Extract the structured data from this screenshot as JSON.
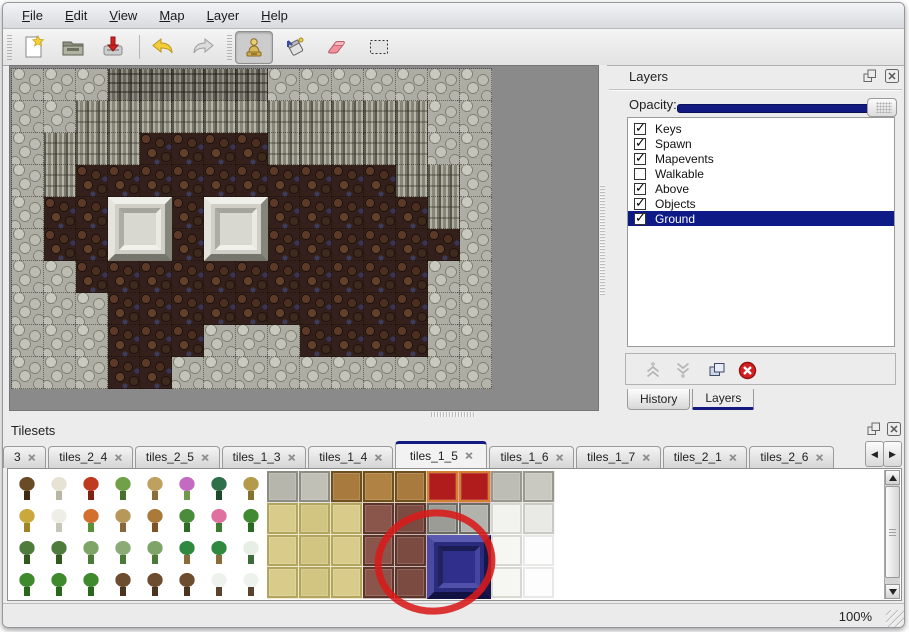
{
  "menu": {
    "items": [
      "File",
      "Edit",
      "View",
      "Map",
      "Layer",
      "Help"
    ]
  },
  "toolbar": {
    "tools": [
      "new",
      "open",
      "save",
      "undo",
      "redo",
      "stamp",
      "fill",
      "eraser",
      "select"
    ],
    "active_tool": "stamp"
  },
  "colors": {
    "accent_navy": "#12197f",
    "selection": "#0e1a86",
    "annotation_red": "#d81a1a",
    "canvas_gray": "#8a8a8a"
  },
  "layers": {
    "title": "Layers",
    "opacity_label": "Opacity:",
    "opacity_value": 100,
    "items": [
      {
        "label": "Keys",
        "checked": true,
        "selected": false
      },
      {
        "label": "Spawn",
        "checked": true,
        "selected": false
      },
      {
        "label": "Mapevents",
        "checked": true,
        "selected": false
      },
      {
        "label": "Walkable",
        "checked": false,
        "selected": false
      },
      {
        "label": "Above",
        "checked": true,
        "selected": false
      },
      {
        "label": "Objects",
        "checked": true,
        "selected": false
      },
      {
        "label": "Ground",
        "checked": true,
        "selected": true
      }
    ],
    "tabs": [
      "History",
      "Layers"
    ],
    "active_tab": "Layers"
  },
  "tilesets": {
    "title": "Tilesets",
    "tabs": [
      {
        "label": "3",
        "active": false
      },
      {
        "label": "tiles_2_4",
        "active": false
      },
      {
        "label": "tiles_2_5",
        "active": false
      },
      {
        "label": "tiles_1_3",
        "active": false
      },
      {
        "label": "tiles_1_4",
        "active": false
      },
      {
        "label": "tiles_1_5",
        "active": true
      },
      {
        "label": "tiles_1_6",
        "active": false
      },
      {
        "label": "tiles_1_7",
        "active": false
      },
      {
        "label": "tiles_2_1",
        "active": false
      },
      {
        "label": "tiles_2_6",
        "active": false
      }
    ],
    "rows": [
      [
        [
          "n",
          "#6b4a26",
          "#3f2a14"
        ],
        [
          "n",
          "#e6e3d5",
          "#b9b6a6"
        ],
        [
          "n",
          "#c03a20",
          "#7c2410"
        ],
        [
          "n",
          "#70a048",
          "#49702c"
        ],
        [
          "n",
          "#bfa05e",
          "#8a6f3c"
        ],
        [
          "n",
          "#c46ac0",
          "#6f9a49"
        ],
        [
          "n",
          "#2f6f49",
          "#1c4a2d"
        ],
        [
          "n",
          "#b59a4b",
          "#84702f"
        ],
        [
          "f",
          "#b7b6ac",
          "#8d8c82"
        ],
        [
          "f",
          "#c1c0b6",
          "#8d8c82"
        ],
        [
          "f",
          "#a87a3e",
          "#6e4f1e"
        ],
        [
          "f",
          "#b08244",
          "#6e4f1e"
        ],
        [
          "f",
          "#a87a3e",
          "#6e4f1e"
        ],
        [
          "f",
          "#b01c1c",
          "#d2822e"
        ],
        [
          "f",
          "#b01c1c",
          "#d2822e"
        ],
        [
          "f",
          "#bdbdb5",
          "#98988e"
        ],
        [
          "f",
          "#c9c9c1",
          "#98988e"
        ]
      ],
      [
        [
          "n",
          "#c9a93c",
          "#a18324"
        ],
        [
          "n",
          "#eeeee6",
          "#c6c6ba"
        ],
        [
          "n",
          "#d4702e",
          "#57923a"
        ],
        [
          "n",
          "#b8985a",
          "#87683a"
        ],
        [
          "n",
          "#a97a3a",
          "#7b5527"
        ],
        [
          "n",
          "#4a8c3b",
          "#2f6b26"
        ],
        [
          "n",
          "#e070a0",
          "#3f7a31"
        ],
        [
          "n",
          "#3f8a33",
          "#2a6a22"
        ],
        [
          "f",
          "#d9cc8b",
          "#b2a55e"
        ],
        [
          "f",
          "#d2c582",
          "#b2a55e"
        ],
        [
          "f",
          "#d9cc8b",
          "#b2a55e"
        ],
        [
          "f",
          "#8a564c",
          "#5c352c"
        ],
        [
          "f",
          "#7b4a40",
          "#5c352c"
        ],
        [
          "f",
          "#9c9c96",
          "#6c6c66"
        ],
        [
          "f",
          "#b3b3ad",
          "#6c6c66"
        ],
        [
          "f",
          "#f2f2ee",
          "#d6d6d0"
        ],
        [
          "f",
          "#e9e9e5",
          "#cacac4"
        ]
      ],
      [
        [
          "n",
          "#4e7c3c",
          "#33591f"
        ],
        [
          "n",
          "#4e7c3c",
          "#33591f"
        ],
        [
          "n",
          "#7fa468",
          "#4c7a38"
        ],
        [
          "n",
          "#8aab74",
          "#4c7a38"
        ],
        [
          "n",
          "#7fa468",
          "#4c7a38"
        ],
        [
          "n",
          "#2f8a3f",
          "#8a6b3a"
        ],
        [
          "n",
          "#2f8a3f",
          "#8a6b3a"
        ],
        [
          "n",
          "#e7efe4",
          "#3c6b3a"
        ],
        [
          "f",
          "#d9cc8b",
          "#b2a55e"
        ],
        [
          "f",
          "#d2c582",
          "#b2a55e"
        ],
        [
          "f",
          "#d9cc8b",
          "#b2a55e"
        ],
        [
          "f",
          "#8a564c",
          "#5c352c"
        ],
        [
          "f",
          "#7b4a40",
          "#5c352c"
        ],
        [
          "f",
          "#2e2e86",
          "#191955"
        ],
        [
          "f",
          "#2e2e86",
          "#191955"
        ],
        [
          "f",
          "#f6f6f3",
          "#d8d8d2"
        ],
        [
          "f",
          "#fdfdfd",
          "#e8e8e6"
        ]
      ],
      [
        [
          "n",
          "#3f8a2c",
          "#2a661c"
        ],
        [
          "n",
          "#3f8a2c",
          "#2a661c"
        ],
        [
          "n",
          "#3f8a2c",
          "#2a661c"
        ],
        [
          "n",
          "#6e4c2e",
          "#4a3420"
        ],
        [
          "n",
          "#6e4c2e",
          "#4a3420"
        ],
        [
          "n",
          "#6e4c2e",
          "#4a3420"
        ],
        [
          "n",
          "#edf2ec",
          "#57432e"
        ],
        [
          "n",
          "#edf2ec",
          "#57432e"
        ],
        [
          "f",
          "#d9cc8b",
          "#b2a55e"
        ],
        [
          "f",
          "#d2c582",
          "#b2a55e"
        ],
        [
          "f",
          "#d9cc8b",
          "#b2a55e"
        ],
        [
          "f",
          "#8a564c",
          "#5c352c"
        ],
        [
          "f",
          "#7b4a40",
          "#5c352c"
        ],
        [
          "f",
          "#2e2e86",
          "#191955"
        ],
        [
          "f",
          "#2e2e86",
          "#191955"
        ],
        [
          "f",
          "#f6f6f3",
          "#d8d8d2"
        ],
        [
          "f",
          "#fdfdfd",
          "#e8e8e6"
        ]
      ]
    ],
    "highlight_block": {
      "col": 13,
      "row": 2,
      "cols": 2,
      "rows": 2
    }
  },
  "map": {
    "legend": {
      "S": "stone-scale",
      "C": "cliff-face",
      "T": "cliff-top",
      "G": "brown-ground"
    },
    "rows": [
      "SSSTTTTTSSSSSSS",
      "SSCCCCCCCCCCCSS",
      "SCCCGGGGCCCCCSS",
      "SCGGGGGGGGGGCCS",
      "SGGGGGGGGGGGGCS",
      "SGGGGGGGGGGGGGS",
      "SSGGGGGGGGGGGSS",
      "SSSGGGGGGGGGGSS",
      "SSSGGGSSSGGGGSS",
      "SSSGGSSSSSSSSSS"
    ],
    "blocks": [
      {
        "col": 3,
        "row": 4
      },
      {
        "col": 6,
        "row": 4
      }
    ]
  },
  "status": {
    "zoom": "100%"
  },
  "annotation": {
    "shape": "ellipse",
    "color": "#d81a1a",
    "cx": 435,
    "cy": 562,
    "rx": 57,
    "ry": 49
  }
}
